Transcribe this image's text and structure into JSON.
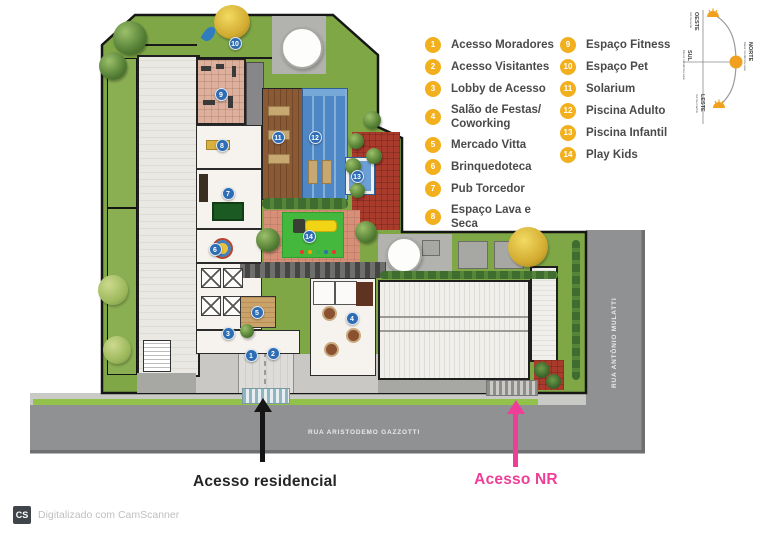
{
  "legend": {
    "badge_color": "#F2B01E",
    "columns": [
      {
        "items": [
          {
            "num": "1",
            "label": "Acesso Moradores"
          },
          {
            "num": "2",
            "label": "Acesso Visitantes"
          },
          {
            "num": "3",
            "label": "Lobby de Acesso"
          },
          {
            "num": "4",
            "label": "Salão de Festas/\nCoworking"
          },
          {
            "num": "5",
            "label": "Mercado Vitta"
          },
          {
            "num": "6",
            "label": "Brinquedoteca"
          },
          {
            "num": "7",
            "label": "Pub Torcedor"
          },
          {
            "num": "8",
            "label": "Espaço Lava e Seca"
          }
        ]
      },
      {
        "items": [
          {
            "num": "9",
            "label": "Espaço Fitness"
          },
          {
            "num": "10",
            "label": "Espaço Pet"
          },
          {
            "num": "11",
            "label": "Solarium"
          },
          {
            "num": "12",
            "label": "Piscina Adulto"
          },
          {
            "num": "13",
            "label": "Piscina Infantil"
          },
          {
            "num": "14",
            "label": "Play Kids"
          }
        ]
      }
    ]
  },
  "plan": {
    "marker_color": "#2E6DB4",
    "markers": [
      {
        "num": "1",
        "x": 251,
        "y": 355
      },
      {
        "num": "2",
        "x": 273,
        "y": 353
      },
      {
        "num": "3",
        "x": 228,
        "y": 333
      },
      {
        "num": "4",
        "x": 352,
        "y": 318
      },
      {
        "num": "5",
        "x": 257,
        "y": 312
      },
      {
        "num": "6",
        "x": 215,
        "y": 249
      },
      {
        "num": "7",
        "x": 228,
        "y": 193
      },
      {
        "num": "8",
        "x": 222,
        "y": 145
      },
      {
        "num": "9",
        "x": 221,
        "y": 94
      },
      {
        "num": "10",
        "x": 235,
        "y": 43
      },
      {
        "num": "11",
        "x": 278,
        "y": 137
      },
      {
        "num": "12",
        "x": 315,
        "y": 137
      },
      {
        "num": "13",
        "x": 357,
        "y": 176
      },
      {
        "num": "14",
        "x": 309,
        "y": 236
      }
    ]
  },
  "streets": {
    "bottom_label": "RUA ARISTODEMO GAZZOTTI",
    "right_label": "RUA ANTÔNIO MULATTI"
  },
  "compass": {
    "north": "NORTE",
    "north_sub": "Maior incidência solar",
    "south": "SUL",
    "south_sub": "Menor incidência solar",
    "west": "OESTE",
    "west_sub": "Sol da tarde",
    "east": "LESTE",
    "east_sub": "Sol da manhã"
  },
  "annotations": {
    "residential_label": "Acesso residencial",
    "nr_label": "Acesso NR",
    "nr_color": "#EE3E97",
    "residential_color": "#1d1d1d"
  },
  "scanner": {
    "logo": "CS",
    "text": "Digitalizado com CamScanner"
  }
}
